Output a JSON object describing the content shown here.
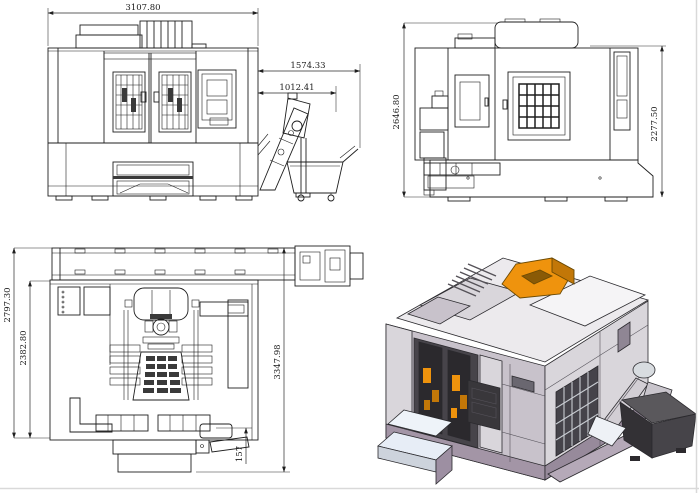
{
  "drawing": {
    "front_view": {
      "dims": {
        "overall_width": "3107.80",
        "conveyor_overall": "1574.33",
        "conveyor_discharge": "1012.41"
      }
    },
    "side_view": {
      "dims": {
        "overall_height": "2646.80",
        "body_height": "2277.50"
      }
    },
    "plan_view": {
      "dims": {
        "overall_depth": "2797.30",
        "body_depth": "2382.80",
        "overall_length": "3347.98",
        "offset": "157"
      }
    },
    "isometric_view": {
      "colors": {
        "accent": "#ef930d",
        "accent_dark": "#c27708",
        "accent_deep": "#8a5a06",
        "top_light": "#eceaed",
        "top_white": "#f5f4f6",
        "body_mid": "#c8c2cb",
        "body_light": "#d9d6db",
        "skirt": "#a395a6",
        "skirt_right": "#978a9b",
        "door_dark": "#47444a",
        "window_dark": "#2b292d",
        "bin_left": "#333135",
        "bin_right": "#464449",
        "steps_white": "#eef3f9"
      }
    },
    "page": {
      "background": "#ffffff",
      "border_color": "#d9d9d9"
    }
  }
}
